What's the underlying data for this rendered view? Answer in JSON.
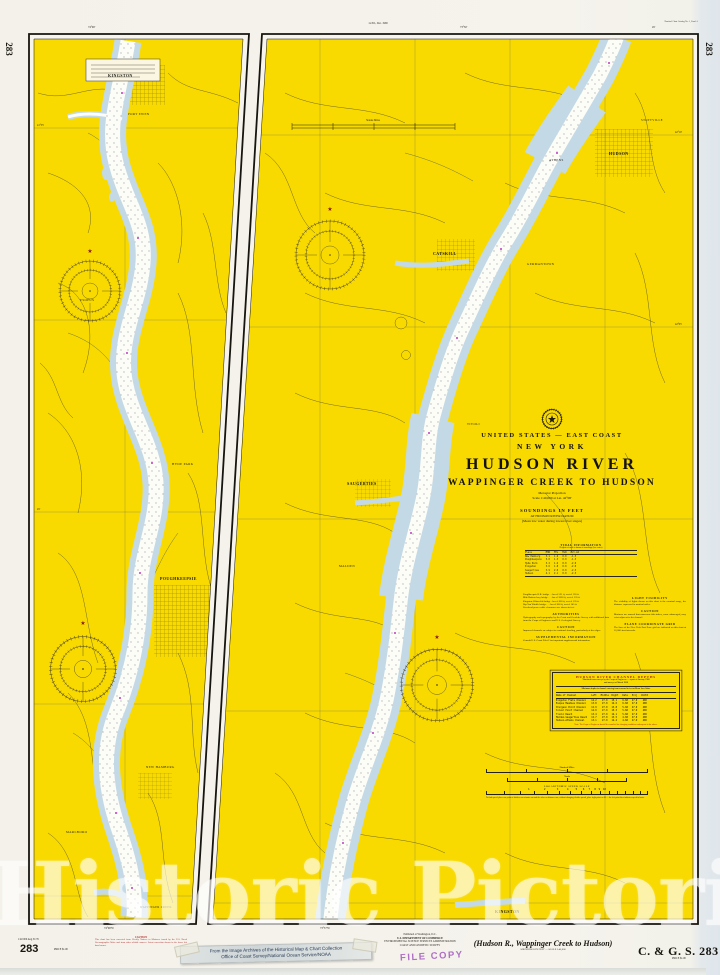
{
  "page": {
    "watermark": "Historic Pictoric ®"
  },
  "margins": {
    "chart_no_side": "283",
    "top_edition_note": "1st Ed., Dec. 1968",
    "catalog_note": "Nautical Chart Catalog No. 1, Panel A",
    "bottom_left_small": "1:40 000  Aug 31/76",
    "bottom_left_no": "283",
    "price": "PRICE $1.00",
    "price_right": "PRICE $1.00",
    "bottom_title": "(Hudson R., Wappinger Creek to Hudson)",
    "bottom_title_sub": "SOUNDINGS IN FEET — SCALE 1:40,000",
    "agency_no": "C. & G. S. 283",
    "publisher_line0": "Published at Washington, D.C.",
    "publisher_line1": "U.S. DEPARTMENT OF COMMERCE",
    "publisher_line2": "ENVIRONMENTAL SCIENCE SERVICES ADMINISTRATION",
    "publisher_line3": "COAST AND GEODETIC SURVEY",
    "sticker_line1": "From the Image Archives of the Historical Map & Chart Collection",
    "sticker_line2": "Office of Coast Survey/National Ocean Service/NOAA",
    "stamp": "FILE COPY",
    "caution_title": "CAUTION",
    "caution_body": "This chart has been corrected from Weekly Notices to Mariners issued by the U.S. Naval Oceanographic Office and from other reliable sources. Latest correction shown in the lower left hand corner."
  },
  "title_block": {
    "region": "UNITED STATES — EAST COAST",
    "state": "NEW YORK",
    "title": "HUDSON RIVER",
    "subtitle": "WAPPINGER CREEK TO HUDSON",
    "projection": "Mercator Projection",
    "scale": "Scale 1:40,000 at Lat. 42°08'",
    "soundings": "SOUNDINGS IN FEET",
    "datum": "AT HUDSON RIVER DATUM",
    "datum_note": "(Mean low water during lowest river stages)"
  },
  "tidal_table": {
    "title": "TIDAL INFORMATION",
    "subtitle": "Heights referred to datum of soundings (low water)",
    "header": "Place          MHW   MTL   MLW   Ext.LW",
    "rows": [
      "New Hamburg    3.1   1.6   0.0   -1.5",
      "Poughkeepsie   3.0   1.5   0.0   -1.5",
      "Hyde Park      3.2   1.6   0.0   -2.0",
      "Kingston       3.6   1.8   0.0   -2.0",
      "Saugerties     3.9   2.0   0.0   -2.5",
      "Hudson         4.1   2.1   0.0   -2.5"
    ]
  },
  "notes": {
    "bridge_lines": [
      "Poughkeepsie R.R. bridge . . hor cl 521 ft, vert cl 130 ft",
      "Mid-Hudson hwy bridge . . . hor cl 3000 ft, vert cl 135 ft",
      "Kingston–Rhinecliff bridge . hor cl 800 ft, vert cl 135 ft",
      "Rip Van Winkle bridge . . . hor cl 800 ft, vert cl 145 ft",
      "Overhead power cable clearances are shown in feet"
    ],
    "authorities_title": "AUTHORITIES",
    "authorities_body": "Hydrography and topography by the Coast and Geodetic Survey with additional data from the Corps of Engineers and U.S. Geological Survey.",
    "caution_title": "CAUTION",
    "caution_body": "Improved channels are subject to continual shoaling, particularly at the edges.",
    "supplemental_title": "SUPPLEMENTAL INFORMATION",
    "supplemental_body": "Consult U.S. Coast Pilot 2 for important supplemental information.",
    "light_title": "LIGHT VISIBILITY",
    "light_body": "The visibility of lights shown on this chart is the nominal range, the distance expressed in nautical miles.",
    "caution2_title": "CAUTION",
    "caution2_body": "Mariners are warned that numerous fish stakes, some submerged, may exist adjacent to the channel.",
    "grid_title": "PLANE COORDINATE GRID",
    "grid_body": "The lines of the New York East Zone grid are indicated on this chart at 10,000-foot intervals."
  },
  "channel_table": {
    "title": "HUDSON RIVER CHANNEL DEPTHS",
    "subtitle1": "Tabulated from surveys by the Corps of Engineers — report of January 1968",
    "subtitle2": "and surveys of March 1968",
    "note": "Minimum depths in channel entering from seaward in feet at Mean Low Water",
    "header": "Name of Channel           Left   Middle  Right   Date   Proj   Width",
    "rows": [
      "Kingston Flats Channel    14.2    27.0   15.1    6-68   27.0    400",
      "Esopus Meadows Channel    13.8    27.0   14.6    6-68   27.0    400",
      "Sturgeon Point Channel    12.9    27.0   13.8    5-68   27.0    400",
      "Silver Point Channel      14.0    27.0   15.3    5-68   27.0    400",
      "Tivoli Reach              13.4    27.0   14.1    5-68   27.0    400",
      "Malden–Saugerties Reach   12.7    27.0   13.5    4-68   27.0    400",
      "Hudson–Athens Channel     13.1    27.0   14.4    4-68   27.0    400"
    ],
    "footnote": "Note: The Corps of Engineers should be consulted for changing conditions subsequent to the above."
  },
  "scales": {
    "nautical": "Nautical Miles",
    "yards": "Yards",
    "log_title": "LOGARITHMIC SPEED SCALE",
    "log_numbers": "1          2        3      4     5    6   7   8  9  10",
    "log_note": "To find speed: place one point of dividers on minutes run and the other on distance run; without changing divider spread, place right point on 60 — the left point then indicates speed in knots.",
    "statute": "Statute Miles"
  },
  "left_panel": {
    "cities": [
      "KINGSTON",
      "PORT EWEN",
      "ESOPUS",
      "HYDE PARK",
      "POUGHKEEPSIE",
      "NEW HAMBURG",
      "MARLBORO",
      "WAPPINGER CREEK"
    ],
    "top_lon": "74°00'",
    "bottom_lon": "74°00'W",
    "lat_a": "41°55'",
    "lat_b": "45'"
  },
  "right_panel": {
    "cities": [
      "HUDSON",
      "ATHENS",
      "STOTTVILLE",
      "CATSKILL",
      "GERMANTOWN",
      "TIVOLI",
      "SAUGERTIES",
      "MALDEN",
      "KINGSTON"
    ],
    "top_lon_a": "73°50'",
    "top_lon_b": "45'",
    "bottom_lon": "73°57'W",
    "lat_a": "42°10'",
    "lat_b": "42°05'"
  }
}
